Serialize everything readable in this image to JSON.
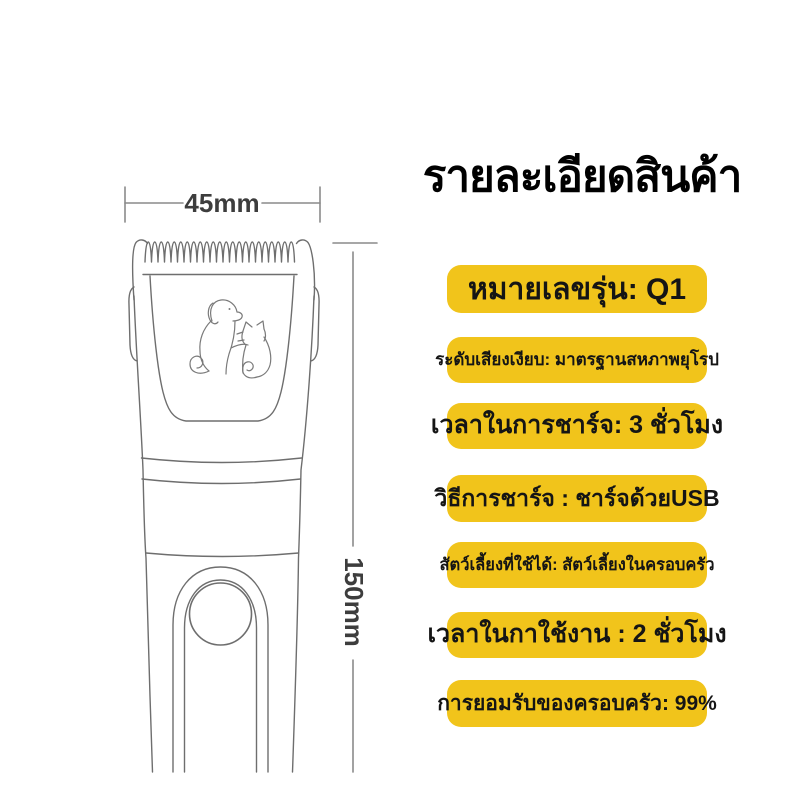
{
  "page": {
    "background": "#FFFFFF",
    "accent_yellow": "#F1C41B",
    "title_color": "#000000",
    "drawing_line_color": "#6E6E6E",
    "dimension_text_color": "#3D3D3D"
  },
  "header": {
    "title": "รายละเอียดสินค้า"
  },
  "diagram": {
    "width_label": "45mm",
    "height_label": "150mm"
  },
  "specs": [
    {
      "text": "หมายเลขรุ่น: Q1"
    },
    {
      "text": "ระดับเสียงเงียบ: มาตรฐานสหภาพยุโรป"
    },
    {
      "text": "เวลาในการชาร์จ: 3 ชั่วโมง"
    },
    {
      "text": "วิธีการชาร์จ : ชาร์จด้วยUSB"
    },
    {
      "text": "สัตว์เลี้ยงที่ใช้ได้: สัตว์เลี้ยงในครอบครัว"
    },
    {
      "text": "เวลาในกาใช้งาน : 2 ชั่วโมง"
    },
    {
      "text": "การยอมรับของครอบครัว: 99%"
    }
  ]
}
